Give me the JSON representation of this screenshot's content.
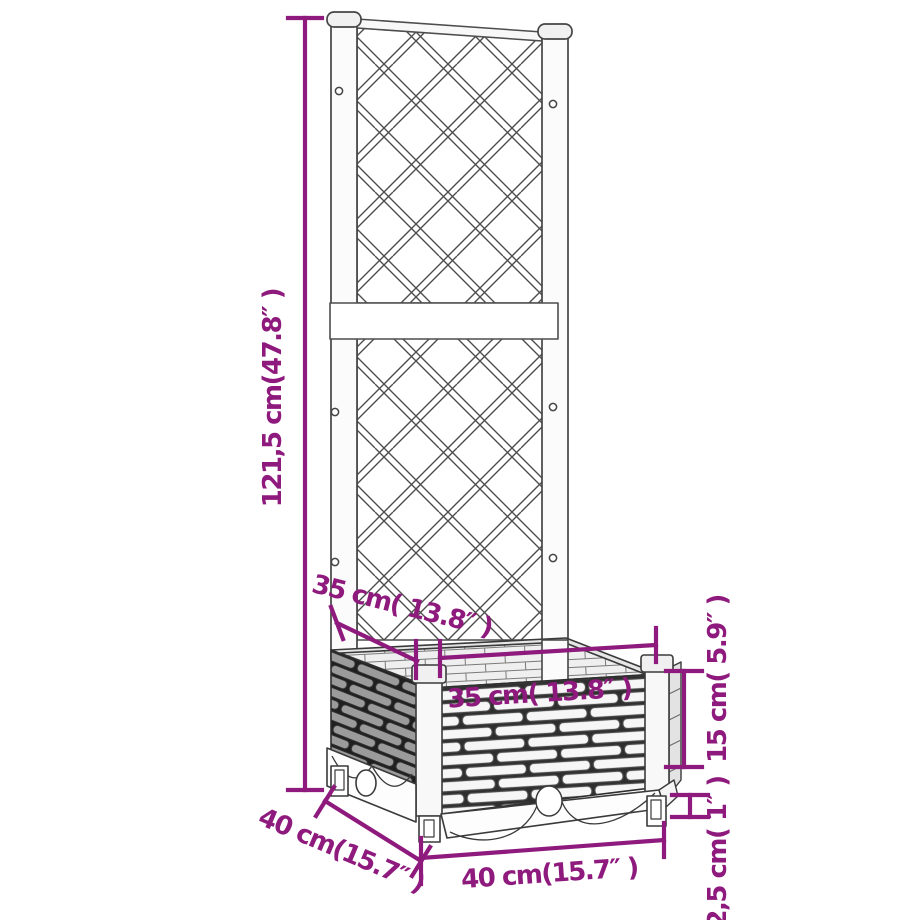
{
  "diagram": {
    "kind": "product-dimension-diagram",
    "product": "garden-planter-with-trellis",
    "accent_color": "#8F1A7D",
    "line_color": "#3A3A3A",
    "labels": {
      "trellis_height": "121,5 cm(47.8″ )",
      "inner_depth": "35 cm( 13.8″ )",
      "inner_width": "35 cm( 13.8″ )",
      "box_height": "15 cm( 5.9″ )",
      "foot_height": "2,5 cm( 1″ )",
      "outer_depth": "40 cm(15.7″ )",
      "outer_width": "40 cm(15.7″ )"
    },
    "dimensions": {
      "trellis_height_cm": "121,5",
      "inner_width_cm": "35",
      "inner_depth_cm": "35",
      "box_height_cm": "15",
      "foot_height_cm": "2,5",
      "outer_width_cm": "40",
      "outer_depth_cm": "40"
    }
  }
}
